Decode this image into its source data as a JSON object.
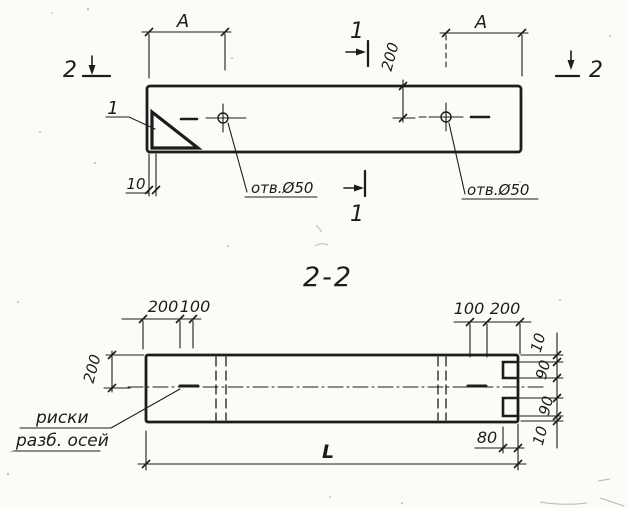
{
  "meta": {
    "paper_color": "#fbfbf8",
    "ink_color": "#1c1c1c",
    "drawing_type": "precast concrete panel shop drawing, plan view and section 2-2"
  },
  "plan_view": {
    "dim_a_left": "A",
    "dim_a_right": "A",
    "dim_200": "200",
    "dim_10": "10",
    "hole_label_left": "отв.Ø50",
    "hole_label_right": "отв.Ø50",
    "section_marker_1_top": "1",
    "section_marker_1_bottom": "1",
    "section_marker_2_left": "2",
    "section_marker_2_right": "2",
    "detail_callout": "1"
  },
  "section_view": {
    "title": "2-2",
    "dim_top_left_200": "200",
    "dim_top_left_100": "100",
    "dim_top_right_100": "100",
    "dim_top_right_200": "200",
    "dim_height_200": "200",
    "dim_chain_top_10": "10",
    "dim_chain_top_90": "90",
    "dim_chain_bottom_90": "90",
    "dim_chain_bottom_10": "10",
    "dim_80": "80",
    "dim_length": "L",
    "axis_marks_label_line1": "риски",
    "axis_marks_label_line2": "разб. осей"
  }
}
